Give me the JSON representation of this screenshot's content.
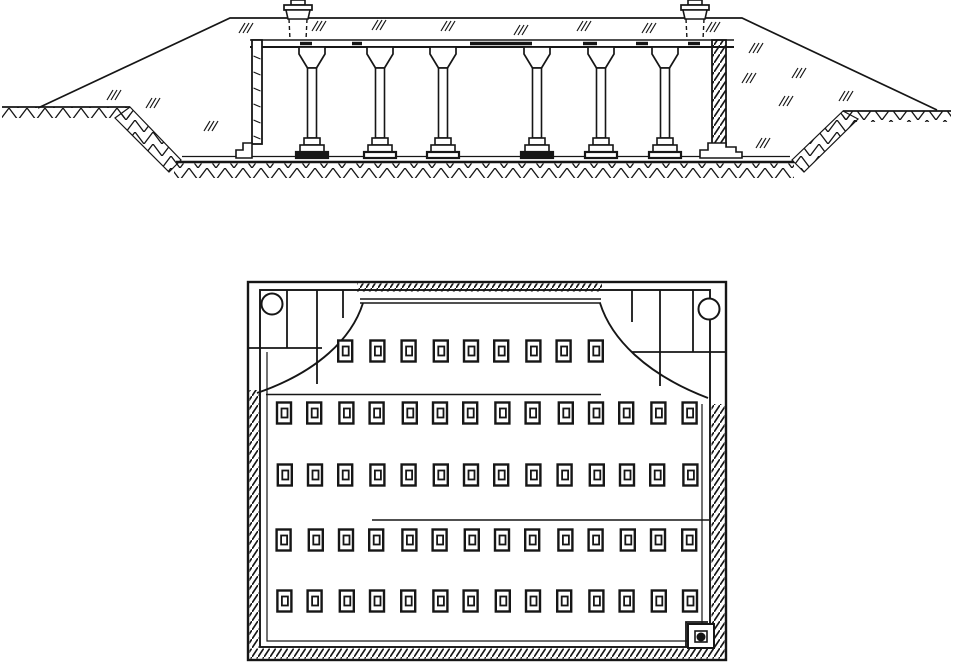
{
  "figure": {
    "kind": "technical-drawing",
    "subject": "underground-columned-cistern",
    "views": [
      "cross-section",
      "plan"
    ],
    "ink_color": "#161616",
    "paper_color": "#ffffff",
    "width": 953,
    "height": 671
  },
  "section": {
    "ground_left": {
      "band": [
        2,
        107,
        128,
        11
      ],
      "line": [
        2,
        107,
        130,
        107
      ]
    },
    "ground_right": {
      "band": [
        843,
        111,
        108,
        11
      ],
      "line": [
        843,
        111,
        951,
        111
      ]
    },
    "mound_path": "M38,108 L230,18 L742,18 L937,110",
    "slope_polys": [
      "130,107 181,160 169,172 115,118",
      "843,111 792,160 804,172 858,119"
    ],
    "floor": {
      "line_thin": [
        182,
        156.5,
        790,
        156.5
      ],
      "line_thick": [
        176,
        162,
        794,
        162
      ],
      "band": [
        174,
        163.5,
        620,
        14.5
      ]
    },
    "roof": {
      "x1": 250,
      "x2": 734,
      "y_top": 40,
      "y_bottom": 47,
      "dashes": [
        [
          300,
          312
        ],
        [
          352,
          362
        ],
        [
          470,
          532
        ],
        [
          583,
          597
        ],
        [
          636,
          648
        ],
        [
          688,
          700
        ]
      ]
    },
    "left_wall": {
      "rect": [
        252,
        40,
        10,
        104
      ],
      "footing": "M236,158 L236,150 L243,150 L243,143 L252,143 L252,158 Z",
      "ticks_y": [
        56,
        72,
        88,
        104,
        120,
        136
      ]
    },
    "right_wall": {
      "rect": [
        712,
        40,
        14,
        106
      ],
      "footing": "M700,158 L700,150 L708,150 L708,143 L726,143 L726,147 L736,147 L736,152 L742,152 L742,158 Z"
    },
    "columns": [
      312,
      380,
      443,
      537,
      601,
      665
    ],
    "column_geom": {
      "cap_half_top": 13,
      "cap_y": 47,
      "cap_slab_h": 7,
      "cap_taper_to_y": 68,
      "shaft_half": 4.5,
      "shaft_bottom": 138,
      "steps": [
        [
          8,
          138,
          7
        ],
        [
          12,
          145,
          7
        ],
        [
          16,
          152,
          6
        ]
      ],
      "dark_base_columns": [
        312,
        537
      ]
    },
    "manholes": [
      {
        "cx": 298
      },
      {
        "cx": 695
      }
    ],
    "manhole_geom": {
      "knob_half": 7,
      "knob_h": 5,
      "slab_half": 14,
      "slab_h": 5,
      "neck_half_top": 12,
      "neck_half_bot": 10,
      "neck_bottom": 19,
      "shaft_half": 9,
      "shaft_bottom_y": 40
    },
    "fill_ticks": [
      [
        245,
        28
      ],
      [
        318,
        26
      ],
      [
        378,
        25
      ],
      [
        447,
        26
      ],
      [
        520,
        30
      ],
      [
        583,
        26
      ],
      [
        648,
        28
      ],
      [
        712,
        27
      ],
      [
        755,
        48
      ],
      [
        748,
        78
      ],
      [
        798,
        73
      ],
      [
        785,
        101
      ],
      [
        845,
        96
      ],
      [
        762,
        143
      ],
      [
        210,
        126
      ],
      [
        113,
        95
      ],
      [
        152,
        103
      ]
    ]
  },
  "plan": {
    "outer": [
      248,
      282,
      478,
      378
    ],
    "inner": [
      260,
      290,
      450,
      357
    ],
    "inner2": {
      "points": "267,352 267,641 702,641 702,404"
    },
    "hatch_bands": {
      "top": [
        357,
        283.5,
        245,
        8
      ],
      "left": [
        249.5,
        390,
        9,
        258
      ],
      "right": [
        711.5,
        404,
        13,
        245
      ],
      "bottom": [
        249.5,
        648.5,
        475,
        10
      ]
    },
    "top_double_lines": [
      [
        360,
        299,
        601,
        299
      ],
      [
        360,
        303,
        601,
        303
      ]
    ],
    "wells": [
      [
        272,
        304,
        10.5
      ],
      [
        709,
        309,
        10.5
      ]
    ],
    "corner_left": {
      "verticals": [
        [
          287,
          290,
          348
        ],
        [
          317,
          290,
          384
        ],
        [
          343,
          290,
          318
        ]
      ],
      "horizontal": [
        249,
        348,
        322,
        348
      ],
      "curve": "M363,303 C352,338 318,372 257,393"
    },
    "corner_right": {
      "verticals": [
        [
          632,
          290,
          322
        ],
        [
          660,
          290,
          386
        ],
        [
          693,
          290,
          352
        ]
      ],
      "horizontal": [
        632,
        352,
        725,
        352
      ],
      "curve": "M600,303 C611,338 645,374 708,398"
    },
    "partitions": [
      [
        266,
        394.5,
        601,
        394.5
      ],
      [
        372,
        520,
        709,
        520
      ]
    ],
    "base_geom": {
      "w": 14,
      "h": 21,
      "iw": 6,
      "ih": 9
    },
    "rows": [
      {
        "y": 351,
        "xs": [
          346,
          377,
          409,
          440,
          471,
          502,
          533,
          564,
          595
        ]
      },
      {
        "y": 413,
        "xs": [
          284,
          315,
          346,
          377,
          409,
          440,
          471,
          502,
          533,
          565,
          596,
          627,
          658,
          690
        ]
      },
      {
        "y": 475,
        "xs": [
          284,
          315,
          346,
          377,
          409,
          440,
          471,
          502,
          533,
          565,
          596,
          627,
          658,
          690
        ]
      },
      {
        "y": 540,
        "xs": [
          284,
          315,
          346,
          377,
          409,
          440,
          471,
          502,
          533,
          565,
          596,
          627,
          658,
          690
        ]
      },
      {
        "y": 601,
        "xs": [
          284,
          315,
          346,
          377,
          409,
          440,
          471,
          502,
          533,
          565,
          596,
          627,
          658,
          690
        ]
      }
    ],
    "sump": {
      "step": "M708,622 L686,622 L686,647",
      "outer": [
        688,
        624,
        26,
        24
      ],
      "inner": [
        695,
        631,
        12,
        11
      ],
      "circle": [
        701,
        637,
        4
      ]
    }
  }
}
